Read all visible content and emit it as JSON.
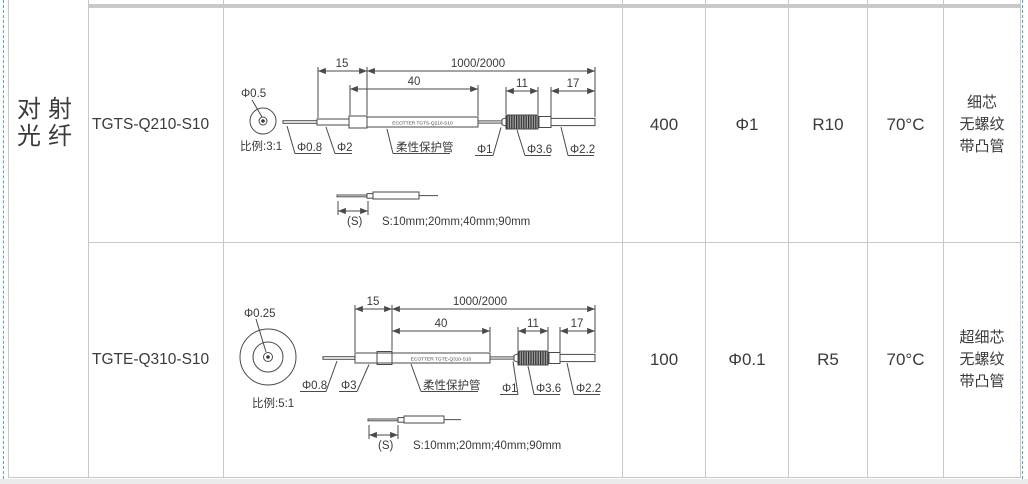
{
  "page": {
    "margin_line_color": "#45b2c3"
  },
  "category": {
    "line1": "对射",
    "line2": "光纤"
  },
  "rows": [
    {
      "model": "TGTS-Q210-S10",
      "values": {
        "distance": "400",
        "core": "Φ1",
        "bend_radius": "R10",
        "temperature": "70°C"
      },
      "features": [
        "细芯",
        "无螺纹",
        "带凸管"
      ],
      "diagram": {
        "tip_diameter": "Φ0.5",
        "scale": "比例:3:1",
        "dim_front": "15",
        "dim_body": "40",
        "dim_length": "1000/2000",
        "dim_knurl": "11",
        "dim_tail": "17",
        "label_fiber": "Φ0.8",
        "label_rod": "Φ2",
        "label_sleeve": "柔性保护管",
        "label_cable": "Φ1",
        "label_knurl": "Φ3.6",
        "label_tail": "Φ2.2",
        "body_marking": "ECOTTER TGTS-Q210-S10",
        "s_label": "(S)",
        "s_options": "S:10mm;20mm;40mm;90mm"
      }
    },
    {
      "model": "TGTE-Q310-S10",
      "values": {
        "distance": "100",
        "core": "Φ0.1",
        "bend_radius": "R5",
        "temperature": "70°C"
      },
      "features": [
        "超细芯",
        "无螺纹",
        "带凸管"
      ],
      "diagram": {
        "tip_diameter": "Φ0.25",
        "scale": "比例:5:1",
        "dim_front": "15",
        "dim_body": "40",
        "dim_length": "1000/2000",
        "dim_knurl": "11",
        "dim_tail": "17",
        "label_fiber": "Φ0.8",
        "label_rod": "Φ3",
        "label_sleeve": "柔性保护管",
        "label_cable": "Φ1",
        "label_knurl": "Φ3.6",
        "label_tail": "Φ2.2",
        "body_marking": "ECOTTER TGTE-Q310-S10",
        "s_label": "(S)",
        "s_options": "S:10mm;20mm;40mm;90mm"
      }
    }
  ]
}
